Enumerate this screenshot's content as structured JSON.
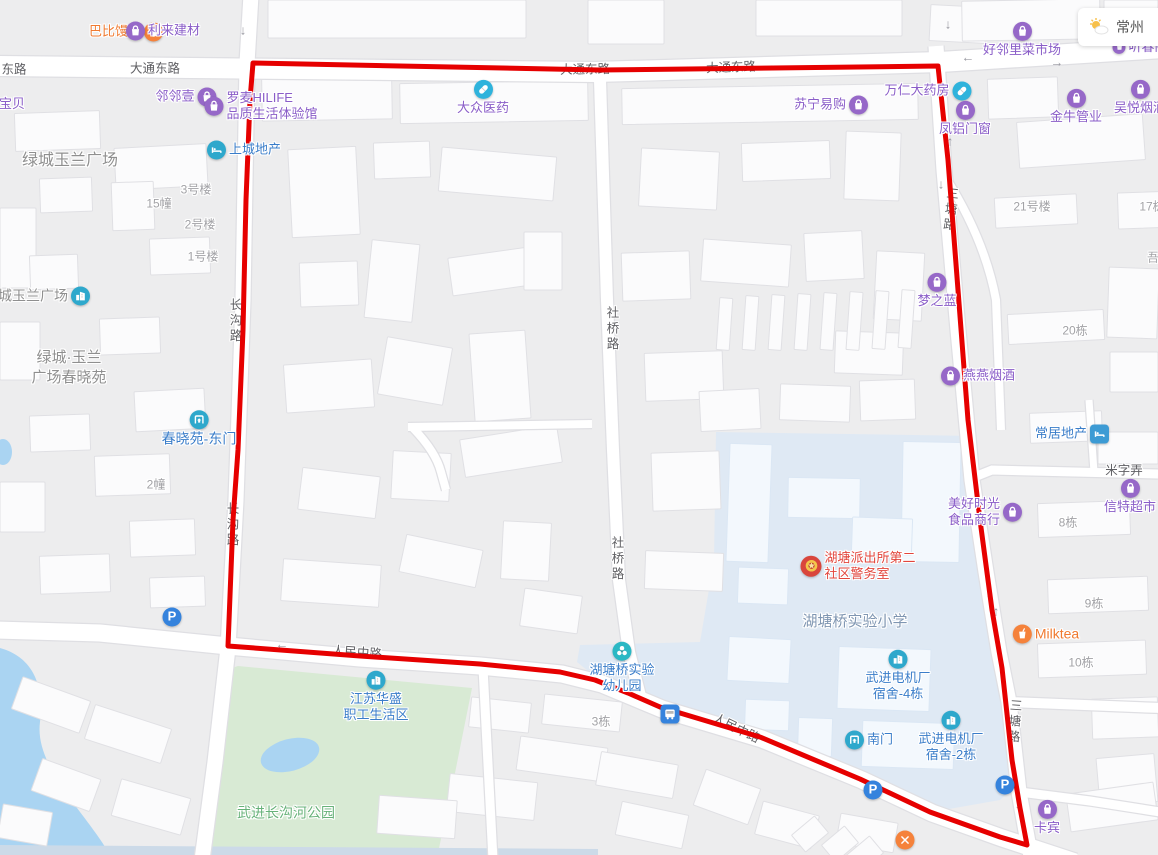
{
  "canvas": {
    "width": 1158,
    "height": 855
  },
  "weather_widget": {
    "city": "常州"
  },
  "colors": {
    "route": "#e60000",
    "icon_purple": "#9668c8",
    "icon_cyan": "#2fb3dc",
    "icon_teal": "#2ea8cc",
    "icon_teal2": "#2bb8c4",
    "icon_blue_sq": "#3d9bd4",
    "icon_parking": "#3583dd",
    "icon_police": "#d9463c",
    "icon_orange": "#f5823b",
    "text_purple": "#8a5dc8",
    "text_blue": "#3a7dc9",
    "text_orange": "#f07a30",
    "text_red": "#e2453c",
    "text_area": "#8f8f8f",
    "text_school": "#7f96b2",
    "text_park": "#67b279",
    "road_label": "#5f5f63",
    "building_label": "#a2a2a6"
  },
  "route_overlay": {
    "color": "#e60000",
    "points": [
      [
        253,
        63
      ],
      [
        600,
        70
      ],
      [
        938,
        66
      ],
      [
        948,
        160
      ],
      [
        958,
        290
      ],
      [
        968,
        420
      ],
      [
        980,
        520
      ],
      [
        992,
        610
      ],
      [
        1002,
        668
      ],
      [
        1012,
        760
      ],
      [
        1020,
        808
      ],
      [
        1027,
        845
      ],
      [
        1000,
        837
      ],
      [
        930,
        812
      ],
      [
        860,
        779
      ],
      [
        760,
        737
      ],
      [
        660,
        707
      ],
      [
        628,
        693
      ],
      [
        595,
        680
      ],
      [
        560,
        672
      ],
      [
        480,
        664
      ],
      [
        360,
        656
      ],
      [
        228,
        646
      ],
      [
        233,
        520
      ],
      [
        238,
        450
      ],
      [
        243,
        330
      ],
      [
        246,
        200
      ],
      [
        250,
        100
      ]
    ]
  },
  "pois": [
    {
      "id": "babi-mantou",
      "label": "巴比馒头",
      "x": 126,
      "y": 32,
      "layout": "icon-right",
      "icon": "bun",
      "icon_bg": "icon_orange",
      "color": "orange"
    },
    {
      "id": "lilai-jiancai",
      "label": "利来建材",
      "x": 163,
      "y": 31,
      "layout": "icon-left",
      "icon": "bag",
      "icon_bg": "icon_purple",
      "color": "purple"
    },
    {
      "id": "haolinli-caishichang",
      "label": "好邻里菜市场",
      "x": 1022,
      "y": 40,
      "layout": "icon-above",
      "icon": "bag",
      "icon_bg": "icon_purple",
      "color": "purple"
    },
    {
      "id": "tingchun",
      "label": "听春阁",
      "x": 1140,
      "y": 47,
      "layout": "icon-left",
      "icon": "bag",
      "icon_bg": "icon_purple",
      "color": "purple",
      "icon_size": 13
    },
    {
      "id": "suning-yigou",
      "label": "苏宁易购",
      "x": 831,
      "y": 105,
      "layout": "icon-right",
      "icon": "bag",
      "icon_bg": "icon_purple",
      "color": "purple"
    },
    {
      "id": "wanren-dayaofang",
      "label": "万仁大药房",
      "x": 928,
      "y": 91,
      "layout": "icon-right",
      "icon": "pill",
      "icon_bg": "icon_cyan",
      "color": "purple"
    },
    {
      "id": "fenglv-menchuang",
      "label": "凤铝门窗",
      "x": 965,
      "y": 119,
      "layout": "icon-above",
      "icon": "bag",
      "icon_bg": "icon_purple",
      "color": "purple"
    },
    {
      "id": "jinniu-guanye",
      "label": "金牛管业",
      "x": 1076,
      "y": 107,
      "layout": "icon-above",
      "icon": "bag",
      "icon_bg": "icon_purple",
      "color": "purple"
    },
    {
      "id": "wuyue-yanjiu",
      "label": "吴悦烟酒",
      "x": 1140,
      "y": 98,
      "layout": "icon-above",
      "icon": "bag",
      "icon_bg": "icon_purple",
      "color": "purple"
    },
    {
      "id": "linlinyi",
      "label": "邻邻壹",
      "x": 186,
      "y": 97,
      "layout": "icon-right",
      "icon": "bag",
      "icon_bg": "icon_purple",
      "color": "purple"
    },
    {
      "id": "baobei",
      "label": "宝贝",
      "x": 12,
      "y": 104,
      "layout": "text-only",
      "color": "purple"
    },
    {
      "id": "dazhong-yiyao",
      "label": "大众医药",
      "x": 483,
      "y": 98,
      "layout": "icon-above",
      "icon": "pill",
      "icon_bg": "icon_cyan",
      "color": "purple"
    },
    {
      "id": "luomai-hilife",
      "lines": [
        "罗麦HILIFE",
        "品质生活体验馆"
      ],
      "x": 261,
      "y": 106,
      "layout": "icon-left",
      "icon": "bag",
      "icon_bg": "icon_purple",
      "color": "purple",
      "align": "left"
    },
    {
      "id": "shangcheng-dichan",
      "label": "上城地产",
      "x": 244,
      "y": 150,
      "layout": "icon-left",
      "icon": "bed",
      "icon_bg": "icon_teal",
      "color": "blue"
    },
    {
      "id": "lvcheng-yulan-plaza",
      "label": "绿城玉兰广场",
      "x": 37,
      "y": 296,
      "layout": "icon-right",
      "icon": "bld",
      "icon_bg": "icon_teal",
      "color": "area",
      "size": 14
    },
    {
      "id": "chunxiaoyuan-dongmen",
      "label": "春晓苑-东门",
      "x": 199,
      "y": 429,
      "layout": "icon-above",
      "icon": "gate",
      "icon_bg": "icon_teal",
      "color": "blue",
      "size": 14
    },
    {
      "id": "mengzhilan",
      "label": "梦之蓝",
      "x": 937,
      "y": 291,
      "layout": "icon-above",
      "icon": "bag",
      "icon_bg": "icon_purple",
      "color": "purple"
    },
    {
      "id": "yanyan-yanjiu",
      "label": "燕燕烟酒",
      "x": 978,
      "y": 376,
      "layout": "icon-left",
      "icon": "bag",
      "icon_bg": "icon_purple",
      "color": "purple"
    },
    {
      "id": "changju-dichan",
      "label": "常居地产",
      "x": 1072,
      "y": 434,
      "layout": "icon-right",
      "icon": "bed",
      "icon_bg": "icon_blue_sq",
      "color": "blue",
      "icon_shape": "square"
    },
    {
      "id": "meihao-shiguang",
      "lines": [
        "美好时光",
        "食品商行"
      ],
      "x": 985,
      "y": 512,
      "layout": "icon-right",
      "icon": "bag",
      "icon_bg": "icon_purple",
      "color": "purple"
    },
    {
      "id": "xinte-chaoshi",
      "label": "信特超市",
      "x": 1130,
      "y": 497,
      "layout": "icon-above",
      "icon": "bag",
      "icon_bg": "icon_purple",
      "color": "purple"
    },
    {
      "id": "milktea",
      "label": "Milktea",
      "x": 1046,
      "y": 634,
      "layout": "icon-left",
      "icon": "cup",
      "icon_bg": "icon_orange",
      "color": "orange",
      "size": 14
    },
    {
      "id": "hutang-police-room",
      "lines": [
        "湖塘派出所第二",
        "社区警务室"
      ],
      "x": 858,
      "y": 566,
      "layout": "icon-left",
      "icon": "badge",
      "icon_bg": "icon_police",
      "color": "red",
      "align": "left",
      "icon_size": 21
    },
    {
      "id": "wujin-dianjichang-dorm4",
      "lines": [
        "武进电机厂",
        "宿舍-4栋"
      ],
      "x": 898,
      "y": 676,
      "layout": "icon-above",
      "icon": "bld",
      "icon_bg": "icon_teal",
      "color": "blue"
    },
    {
      "id": "nanmen",
      "label": "南门",
      "x": 869,
      "y": 740,
      "layout": "icon-left",
      "icon": "gate",
      "icon_bg": "icon_teal",
      "color": "blue"
    },
    {
      "id": "wujin-dianjichang-dorm2",
      "lines": [
        "武进电机厂",
        "宿舍-2栋"
      ],
      "x": 951,
      "y": 737,
      "layout": "icon-above",
      "icon": "bld",
      "icon_bg": "icon_teal",
      "color": "blue"
    },
    {
      "id": "kabin",
      "label": "卡宾",
      "x": 1047,
      "y": 818,
      "layout": "icon-above",
      "icon": "bag",
      "icon_bg": "icon_purple",
      "color": "purple"
    },
    {
      "id": "hutangqiao-kindergarten",
      "lines": [
        "湖塘桥实验",
        "幼儿园"
      ],
      "x": 622,
      "y": 668,
      "layout": "icon-above",
      "icon": "flower",
      "icon_bg": "icon_teal2",
      "color": "blue"
    },
    {
      "id": "jiangsu-huasheng",
      "lines": [
        "江苏华盛",
        "职工生活区"
      ],
      "x": 376,
      "y": 697,
      "layout": "icon-above",
      "icon": "bld",
      "icon_bg": "icon_teal",
      "color": "blue"
    },
    {
      "id": "parking-west",
      "x": 172,
      "y": 617,
      "layout": "icon-only",
      "icon": "P",
      "icon_bg": "icon_parking"
    },
    {
      "id": "parking-south",
      "x": 873,
      "y": 790,
      "layout": "icon-only",
      "icon": "P",
      "icon_bg": "icon_parking"
    },
    {
      "id": "parking-east",
      "x": 1005,
      "y": 785,
      "layout": "icon-only",
      "icon": "P",
      "icon_bg": "icon_parking"
    },
    {
      "id": "bus-stop",
      "x": 670,
      "y": 714,
      "layout": "icon-only",
      "icon": "bus",
      "icon_bg": "icon_parking",
      "icon_shape": "square"
    },
    {
      "id": "restaurant",
      "x": 905,
      "y": 840,
      "layout": "icon-only",
      "icon": "x",
      "icon_bg": "icon_orange"
    }
  ],
  "road_labels": [
    {
      "text": "东路",
      "x": 14,
      "y": 68
    },
    {
      "text": "大通东路",
      "x": 155,
      "y": 67
    },
    {
      "text": "大通东路",
      "x": 585,
      "y": 68,
      "rotate": -1
    },
    {
      "text": "大通东路",
      "x": 731,
      "y": 66,
      "rotate": -2
    },
    {
      "text": "长沟路",
      "x": 235,
      "y": 321,
      "vertical": true
    },
    {
      "text": "长沟路",
      "x": 232,
      "y": 525,
      "vertical": true
    },
    {
      "text": "社桥路",
      "x": 612,
      "y": 329,
      "vertical": true
    },
    {
      "text": "社桥路",
      "x": 617,
      "y": 559,
      "vertical": true
    },
    {
      "text": "三塘路",
      "x": 950,
      "y": 210,
      "vertical": true,
      "rotate": 6
    },
    {
      "text": "三塘路",
      "x": 1014,
      "y": 722,
      "vertical": true,
      "rotate": 4
    },
    {
      "text": "人民中路",
      "x": 357,
      "y": 651,
      "rotate": 4
    },
    {
      "text": "人民中路",
      "x": 737,
      "y": 727,
      "rotate": 26
    },
    {
      "text": "米字弄",
      "x": 1124,
      "y": 469
    }
  ],
  "building_labels": [
    {
      "text": "15幢",
      "x": 159,
      "y": 203
    },
    {
      "text": "3号楼",
      "x": 196,
      "y": 189
    },
    {
      "text": "2号楼",
      "x": 200,
      "y": 224
    },
    {
      "text": "1号楼",
      "x": 203,
      "y": 256
    },
    {
      "text": "2幢",
      "x": 156,
      "y": 484
    },
    {
      "text": "21号楼",
      "x": 1032,
      "y": 206
    },
    {
      "text": "17栋",
      "x": 1152,
      "y": 206
    },
    {
      "text": "吾",
      "x": 1153,
      "y": 257
    },
    {
      "text": "20栋",
      "x": 1075,
      "y": 330
    },
    {
      "text": "8栋",
      "x": 1068,
      "y": 522
    },
    {
      "text": "9栋",
      "x": 1094,
      "y": 603
    },
    {
      "text": "10栋",
      "x": 1081,
      "y": 662
    },
    {
      "text": "3栋",
      "x": 601,
      "y": 721
    }
  ],
  "area_labels": [
    {
      "lines": [
        "绿城玉兰广场"
      ],
      "x": 70,
      "y": 161,
      "size": 16,
      "color": "area"
    },
    {
      "lines": [
        "绿城·玉兰",
        "广场春晓苑"
      ],
      "x": 69,
      "y": 368,
      "size": 15,
      "color": "area"
    },
    {
      "lines": [
        "湖塘桥实验小学"
      ],
      "x": 855,
      "y": 622,
      "size": 15,
      "color": "school"
    },
    {
      "lines": [
        "武进长沟河公园"
      ],
      "x": 286,
      "y": 813,
      "size": 14,
      "color": "park"
    }
  ],
  "arrows": [
    {
      "x": 243,
      "y": 30,
      "d": "↓"
    },
    {
      "x": 247,
      "y": 186,
      "d": "↓"
    },
    {
      "x": 948,
      "y": 24,
      "d": "↓"
    },
    {
      "x": 941,
      "y": 184,
      "d": "↓"
    },
    {
      "x": 950,
      "y": 141,
      "d": "↑"
    },
    {
      "x": 968,
      "y": 57,
      "d": "←"
    },
    {
      "x": 1057,
      "y": 62,
      "d": "→"
    },
    {
      "x": 962,
      "y": 329,
      "d": "↓"
    },
    {
      "x": 989,
      "y": 593,
      "d": "↓"
    },
    {
      "x": 996,
      "y": 611,
      "d": "↑"
    },
    {
      "x": 282,
      "y": 644,
      "d": "←"
    },
    {
      "x": 1018,
      "y": 804,
      "d": "↓"
    }
  ]
}
